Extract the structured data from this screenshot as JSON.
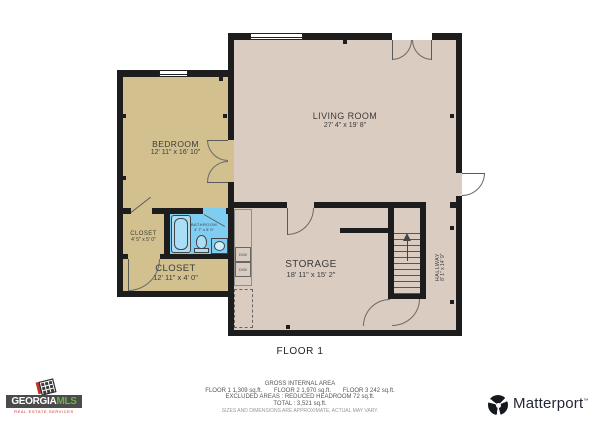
{
  "plan": {
    "floor_label": "FLOOR 1",
    "rooms": {
      "bedroom": {
        "name": "BEDROOM",
        "dims": "12' 11\" x 16' 10\""
      },
      "living_room": {
        "name": "LIVING ROOM",
        "dims": "27' 4\" x 19' 8\""
      },
      "storage": {
        "name": "STORAGE",
        "dims": "18' 11\" x 15' 2\""
      },
      "closet_small": {
        "name": "CLOSET",
        "dims": "4' 5\" x 5' 0\""
      },
      "closet_long": {
        "name": "CLOSET",
        "dims": "12' 11\" x 4' 0\""
      },
      "bathroom": {
        "name": "BATHROOM",
        "dims": "4' 7\" x 5' 0\""
      },
      "hallway": {
        "name": "HALLWAY",
        "dims": "8' 1\" x 14' 9\""
      }
    },
    "appliances": [
      "D/W",
      "D/W"
    ]
  },
  "footer": {
    "area_title": "GROSS INTERNAL AREA",
    "floors": [
      "FLOOR 1 1,309 sq.ft.",
      "FLOOR 2 1,970 sq.ft.",
      "FLOOR 3 242 sq.ft."
    ],
    "excluded": "EXCLUDED AREAS :  REDUCED HEADROOM 72 sq.ft.",
    "total": "TOTAL :  3,521 sq.ft.",
    "disclaimer": "SIZES AND DIMENSIONS ARE APPROXIMATE, ACTUAL MAY VARY."
  },
  "logos": {
    "georgia_mls": {
      "brand": "GEORGIA",
      "brand_suffix": "MLS",
      "tagline": "REAL ESTATE SERVICES"
    },
    "matterport": {
      "label": "Matterport",
      "mark": "™"
    }
  },
  "colors": {
    "wall": "#1d1d1d",
    "tan": "#d3c08f",
    "mauve": "#dbccc1",
    "bathroom_blue": "#7fcef2",
    "tub_blue": "#aadef6",
    "mls_green": "#6db33f",
    "mls_red": "#c43127",
    "banner_gray": "#4b4b4b",
    "matterport_navy": "#232735"
  }
}
